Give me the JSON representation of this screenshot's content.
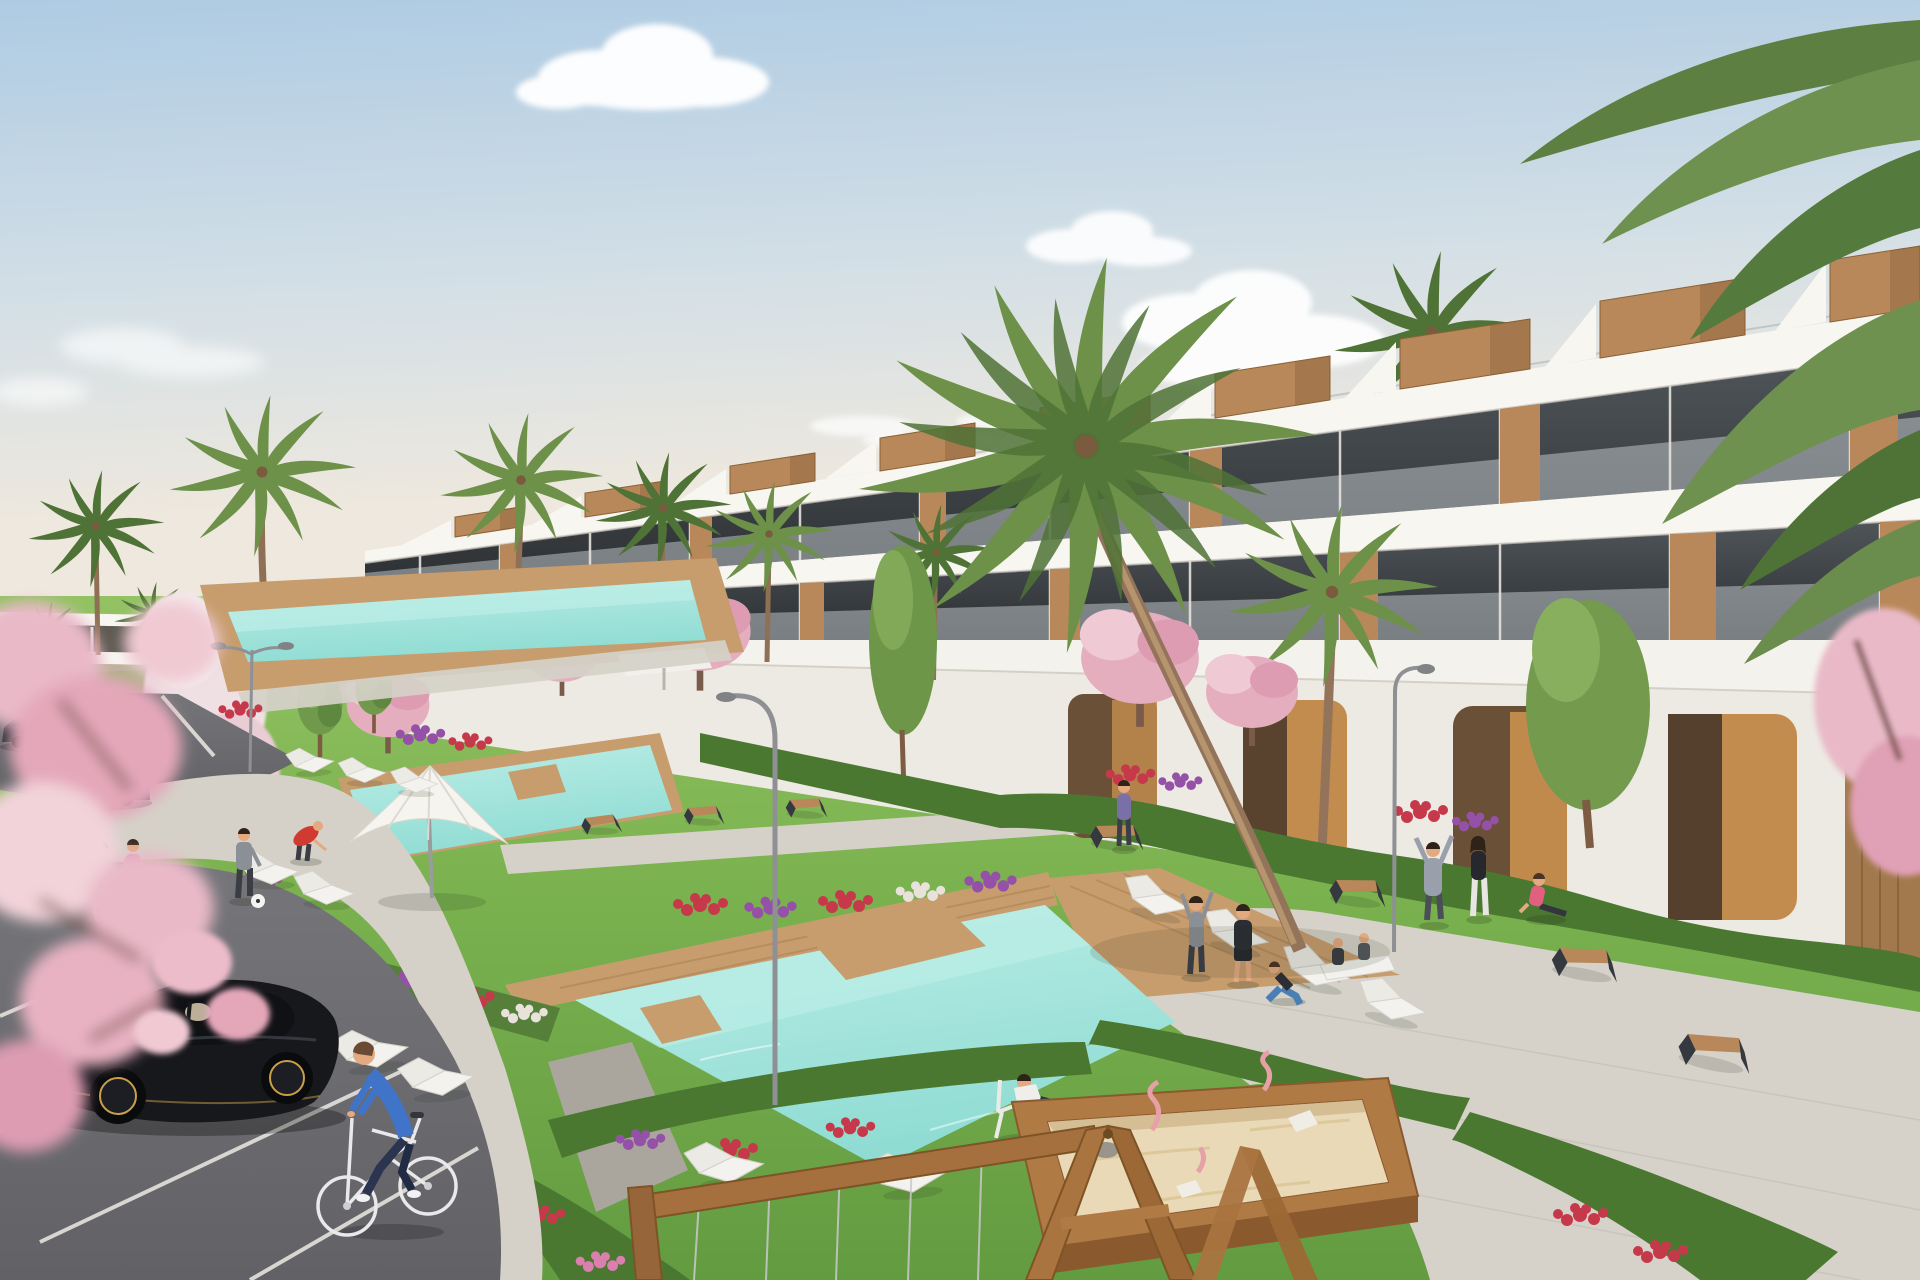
{
  "scene": {
    "type": "3d-architectural-render",
    "setting": "Modern white terraced apartment complex with communal pools and gardens",
    "time_of_day": "daytime, clear sky with scattered clouds",
    "camera": "elevated three-quarter view",
    "features": [
      "stepped white apartment block with wooden rooftop boxes, stair parapets and glass balconies",
      "ochre and timber clad ground-floor arcade",
      "two turquoise lap pools with timber sun decks",
      "white parasol and white sun loungers",
      "lawns, hedges and red, purple and pink flower beds",
      "palm trees and pink cherry-blossom trees",
      "curved grey street lamps",
      "asphalt parking with white bays, two parked sedans and a black hatchback",
      "man riding a white bicycle",
      "two women jogging on the footpath",
      "residents stretching and doing yoga on the lawn",
      "man relaxing in a white deck chair beside the pool",
      "timber playground frame and large sandbox with pink spring riders",
      "paved promenade with angular timber benches"
    ],
    "people_count": 15,
    "vehicles": {
      "parked_cars": 3,
      "bicycles": 1
    }
  },
  "palette": {
    "sky_top": "#aecbe3",
    "sky_mid": "#d3dfe6",
    "sky_horizon": "#eee8de",
    "cloud": "#ffffff",
    "facade": "#f4f2ec",
    "facade_shade": "#ded9d1",
    "slab": "#f8f6f1",
    "glass": "#3c4145",
    "balustrade": "#c7ced2",
    "wood": "#b9885a",
    "wood_dark": "#96693c",
    "ochre": "#c08a4d",
    "grass": "#7cb350",
    "grass_deep": "#639b41",
    "hedge": "#4b7831",
    "flower_red": "#c6394b",
    "flower_purple": "#9550a8",
    "flower_pink": "#db7fae",
    "blossom": "#e9b9c8",
    "palm": "#6d9149",
    "palm_dark": "#4f7336",
    "pool": "#8fdcd3",
    "pool_light": "#bceee7",
    "deck": "#c79d6e",
    "deck_dark": "#a87e51",
    "path": "#d5d1c8",
    "asphalt": "#76767a",
    "asphalt_dark": "#626266",
    "line_white": "#e6e3de",
    "car_black": "#17181c",
    "car_slate": "#3a4454",
    "metal": "#8e9094",
    "bench_dark": "#35383e",
    "sand": "#e9d9b6",
    "timber": "#a5703d",
    "skin": "#e3a981",
    "blue_shirt": "#3f74c9",
    "jeans": "#2b3550",
    "teal": "#3fbfb0",
    "pink": "#e298b5",
    "red": "#cf3b30",
    "gray_cloth": "#8b8f96",
    "dark_cloth": "#2c2e35",
    "white_cloth": "#efeeea"
  }
}
